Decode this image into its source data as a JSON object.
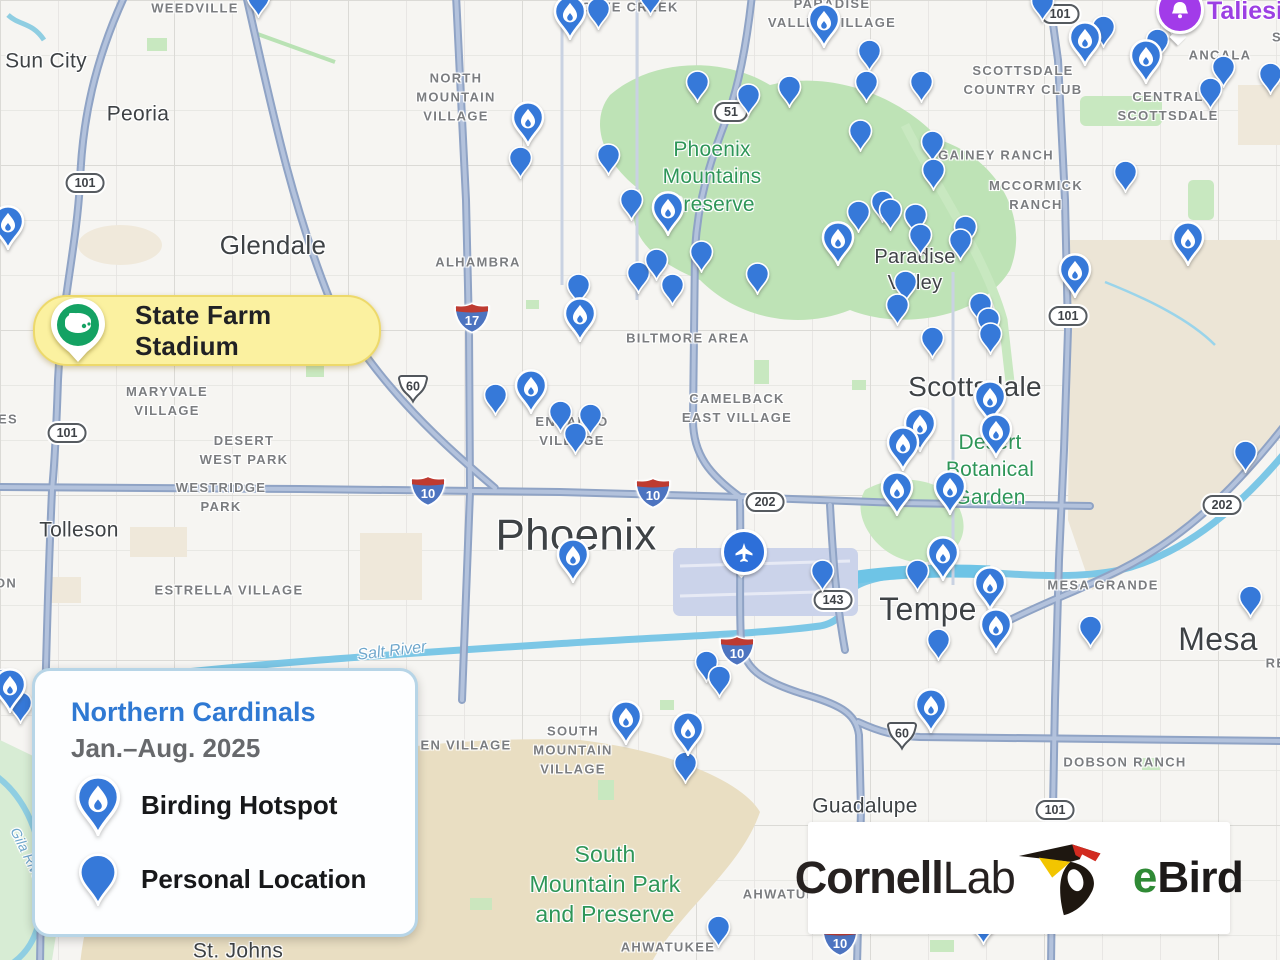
{
  "legend": {
    "title": "Northern Cardinals",
    "subtitle": "Jan.–Aug. 2025",
    "items": [
      {
        "type": "hotspot",
        "label": "Birding Hotspot"
      },
      {
        "type": "personal",
        "label": "Personal Location"
      }
    ]
  },
  "logo": {
    "cornell": "Cornell",
    "lab": "Lab",
    "ebird_e": "e",
    "ebird_bird": "Bird"
  },
  "markers": {
    "stadium": {
      "label": "State Farm Stadium"
    },
    "taliesin": {
      "label": "Taliesin"
    },
    "airport": {
      "icon": "airplane-icon"
    }
  },
  "colors": {
    "pin_blue": "#3679D9",
    "legend_title_blue": "#2F79D3",
    "subtitle_gray": "#67696C",
    "stadium_yellow": "#FBF1A0",
    "stadium_green": "#14A263",
    "taliesin_purple": "#A23BE9",
    "airport_blue": "#2D6FD9",
    "park_green": "#2E9658",
    "water_blue": "#6FA7CC",
    "ebird_green": "#2F8A35"
  },
  "map": {
    "labels": [
      {
        "text": "Sun City",
        "x": 46,
        "y": 61,
        "cls": "city",
        "size": 21
      },
      {
        "text": "Peoria",
        "x": 138,
        "y": 114,
        "cls": "city",
        "size": 21
      },
      {
        "text": "Glendale",
        "x": 273,
        "y": 246,
        "cls": "city",
        "size": 26
      },
      {
        "text": "Tolleson",
        "x": 79,
        "y": 530,
        "cls": "city",
        "size": 21
      },
      {
        "text": "Phoenix",
        "x": 576,
        "y": 535,
        "cls": "city",
        "size": 44
      },
      {
        "text": "Scottsdale",
        "x": 975,
        "y": 387,
        "cls": "city",
        "size": 28
      },
      {
        "text": "Tempe",
        "x": 928,
        "y": 610,
        "cls": "city",
        "size": 32
      },
      {
        "text": "Mesa",
        "x": 1218,
        "y": 640,
        "cls": "city",
        "size": 32
      },
      {
        "text": "Guadalupe",
        "x": 865,
        "y": 806,
        "cls": "city",
        "size": 21
      },
      {
        "text": "St. Johns",
        "x": 238,
        "y": 951,
        "cls": "city",
        "size": 21
      },
      {
        "text": "Paradise\nValley",
        "x": 915,
        "y": 270,
        "cls": "city",
        "size": 20
      },
      {
        "text": "WEEDVILLE",
        "x": 195,
        "y": 9,
        "cls": "area"
      },
      {
        "text": "CAVE CREEK",
        "x": 630,
        "y": 8,
        "cls": "area"
      },
      {
        "text": "PARADISE\nVALLEY VILLAGE",
        "x": 832,
        "y": 14,
        "cls": "area"
      },
      {
        "text": "NORTH\nMOUNTAIN\nVILLAGE",
        "x": 456,
        "y": 98,
        "cls": "area"
      },
      {
        "text": "SCOTTSDALE\nCOUNTRY CLUB",
        "x": 1023,
        "y": 81,
        "cls": "area"
      },
      {
        "text": "ANCALA",
        "x": 1220,
        "y": 56,
        "cls": "area"
      },
      {
        "text": "CENTRAL\nSCOTTSDALE",
        "x": 1168,
        "y": 107,
        "cls": "area"
      },
      {
        "text": "GAINEY RANCH",
        "x": 996,
        "y": 156,
        "cls": "area"
      },
      {
        "text": "MCCORMICK\nRANCH",
        "x": 1036,
        "y": 196,
        "cls": "area"
      },
      {
        "text": "ALHAMBRA",
        "x": 478,
        "y": 263,
        "cls": "area"
      },
      {
        "text": "MARYVALE\nVILLAGE",
        "x": 167,
        "y": 402,
        "cls": "area"
      },
      {
        "text": "BILTMORE AREA",
        "x": 688,
        "y": 339,
        "cls": "area"
      },
      {
        "text": "CAMELBACK\nEAST VILLAGE",
        "x": 737,
        "y": 409,
        "cls": "area"
      },
      {
        "text": "ENCANTO\nVILLAGE",
        "x": 572,
        "y": 432,
        "cls": "area"
      },
      {
        "text": "DESERT\nWEST PARK",
        "x": 244,
        "y": 451,
        "cls": "area"
      },
      {
        "text": "WESTRIDGE\nPARK",
        "x": 221,
        "y": 498,
        "cls": "area"
      },
      {
        "text": "ESTRELLA VILLAGE",
        "x": 229,
        "y": 591,
        "cls": "area"
      },
      {
        "text": "MESA GRANDE",
        "x": 1103,
        "y": 586,
        "cls": "area"
      },
      {
        "text": "DOBSON RANCH",
        "x": 1125,
        "y": 763,
        "cls": "area"
      },
      {
        "text": "SOUTH\nMOUNTAIN\nVILLAGE",
        "x": 573,
        "y": 751,
        "cls": "area"
      },
      {
        "text": "AHWATUKEE",
        "x": 668,
        "y": 948,
        "cls": "area"
      },
      {
        "text": "AHWATUKEE",
        "x": 790,
        "y": 895,
        "cls": "area"
      },
      {
        "text": "EN VILLAGE",
        "x": 466,
        "y": 746,
        "cls": "area"
      },
      {
        "text": "ES",
        "x": 8,
        "y": 420,
        "cls": "frag"
      },
      {
        "text": "ON",
        "x": 6,
        "y": 584,
        "cls": "frag"
      },
      {
        "text": "RE",
        "x": 1276,
        "y": 664,
        "cls": "frag"
      },
      {
        "text": "S",
        "x": 1277,
        "y": 38,
        "cls": "frag"
      },
      {
        "text": "Phoenix\nMountains\nPreserve",
        "x": 712,
        "y": 177,
        "cls": "park",
        "size": 21
      },
      {
        "text": "Desert\nBotanical\nGarden",
        "x": 990,
        "y": 470,
        "cls": "park",
        "size": 21
      },
      {
        "text": "South\nMountain Park\nand Preserve",
        "x": 605,
        "y": 885,
        "cls": "park",
        "size": 23
      },
      {
        "text": "Salt River",
        "x": 392,
        "y": 652,
        "cls": "water",
        "size": 16,
        "rot": -7
      },
      {
        "text": "Gila River",
        "x": 28,
        "y": 856,
        "cls": "water",
        "size": 14,
        "rot": 64
      }
    ],
    "shields": [
      {
        "kind": "interstate",
        "label": "17",
        "x": 472,
        "y": 318
      },
      {
        "kind": "interstate",
        "label": "10",
        "x": 428,
        "y": 491
      },
      {
        "kind": "interstate",
        "label": "10",
        "x": 653,
        "y": 493
      },
      {
        "kind": "interstate",
        "label": "10",
        "x": 737,
        "y": 651
      },
      {
        "kind": "interstate",
        "label": "10",
        "x": 840,
        "y": 941
      },
      {
        "kind": "us",
        "label": "60",
        "x": 413,
        "y": 389
      },
      {
        "kind": "us",
        "label": "60",
        "x": 902,
        "y": 736
      },
      {
        "kind": "state",
        "label": "101",
        "x": 85,
        "y": 183
      },
      {
        "kind": "state",
        "label": "101",
        "x": 67,
        "y": 433
      },
      {
        "kind": "state",
        "label": "101",
        "x": 1060,
        "y": 14
      },
      {
        "kind": "state",
        "label": "101",
        "x": 1068,
        "y": 316
      },
      {
        "kind": "state",
        "label": "101",
        "x": 1055,
        "y": 810
      },
      {
        "kind": "state",
        "label": "202",
        "x": 765,
        "y": 502
      },
      {
        "kind": "state",
        "label": "202",
        "x": 1222,
        "y": 505
      },
      {
        "kind": "state",
        "label": "51",
        "x": 731,
        "y": 112
      },
      {
        "kind": "state",
        "label": "143",
        "x": 833,
        "y": 600
      }
    ],
    "pins": {
      "hotspot": [
        [
          8,
          250
        ],
        [
          570,
          40
        ],
        [
          824,
          48
        ],
        [
          528,
          146
        ],
        [
          668,
          236
        ],
        [
          838,
          266
        ],
        [
          1085,
          66
        ],
        [
          1146,
          84
        ],
        [
          1188,
          266
        ],
        [
          1075,
          298
        ],
        [
          580,
          342
        ],
        [
          531,
          414
        ],
        [
          920,
          452
        ],
        [
          990,
          425
        ],
        [
          996,
          458
        ],
        [
          903,
          471
        ],
        [
          950,
          515
        ],
        [
          897,
          516
        ],
        [
          943,
          581
        ],
        [
          990,
          611
        ],
        [
          996,
          653
        ],
        [
          573,
          583
        ],
        [
          931,
          733
        ],
        [
          626,
          745
        ],
        [
          688,
          756
        ],
        [
          10,
          713
        ]
      ],
      "personal": [
        [
          258,
          18
        ],
        [
          598,
          30
        ],
        [
          650,
          16
        ],
        [
          697,
          103
        ],
        [
          748,
          116
        ],
        [
          789,
          108
        ],
        [
          869,
          72
        ],
        [
          866,
          103
        ],
        [
          921,
          103
        ],
        [
          860,
          152
        ],
        [
          608,
          176
        ],
        [
          520,
          179
        ],
        [
          631,
          221
        ],
        [
          638,
          294
        ],
        [
          656,
          281
        ],
        [
          672,
          306
        ],
        [
          701,
          273
        ],
        [
          757,
          295
        ],
        [
          1042,
          22
        ],
        [
          1103,
          48
        ],
        [
          1172,
          36
        ],
        [
          1223,
          88
        ],
        [
          1270,
          95
        ],
        [
          1210,
          110
        ],
        [
          1157,
          61
        ],
        [
          932,
          163
        ],
        [
          933,
          191
        ],
        [
          1125,
          193
        ],
        [
          882,
          223
        ],
        [
          858,
          233
        ],
        [
          890,
          231
        ],
        [
          915,
          236
        ],
        [
          920,
          256
        ],
        [
          965,
          248
        ],
        [
          960,
          261
        ],
        [
          905,
          303
        ],
        [
          897,
          326
        ],
        [
          932,
          359
        ],
        [
          980,
          325
        ],
        [
          988,
          340
        ],
        [
          990,
          355
        ],
        [
          1245,
          473
        ],
        [
          578,
          306
        ],
        [
          560,
          433
        ],
        [
          590,
          436
        ],
        [
          575,
          455
        ],
        [
          495,
          416
        ],
        [
          822,
          592
        ],
        [
          917,
          592
        ],
        [
          938,
          661
        ],
        [
          1250,
          618
        ],
        [
          1090,
          648
        ],
        [
          685,
          784
        ],
        [
          718,
          948
        ],
        [
          983,
          945
        ],
        [
          706,
          683
        ],
        [
          719,
          698
        ],
        [
          3,
          701
        ],
        [
          20,
          724
        ]
      ]
    }
  }
}
